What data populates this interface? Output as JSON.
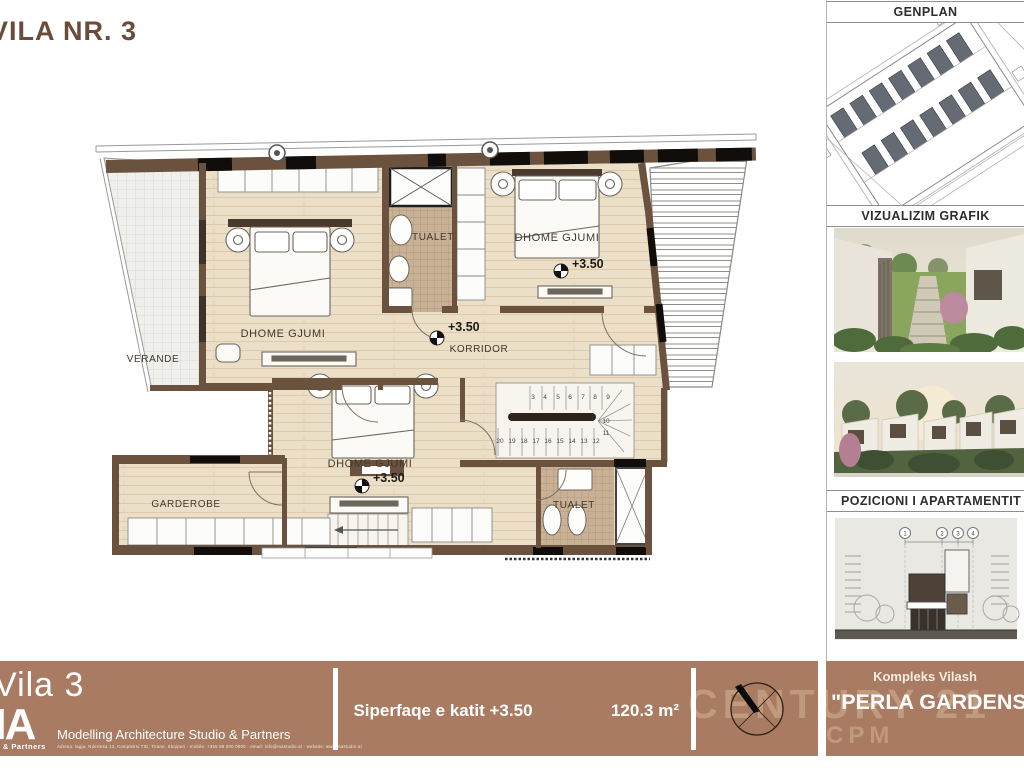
{
  "title": "VILA NR. 3",
  "plan": {
    "labels": {
      "bedroom": "DHOME GJUMI",
      "toilet": "TUALET",
      "corridor": "KORRIDOR",
      "veranda": "VERANDE",
      "wardrobe": "GARDEROBE",
      "level": "+3.50"
    },
    "stairs": {
      "top": [
        "3",
        "4",
        "5",
        "6",
        "7",
        "8",
        "9"
      ],
      "right": [
        "10",
        "11"
      ],
      "bottom": [
        "20",
        "19",
        "18",
        "17",
        "16",
        "15",
        "14",
        "13",
        "12"
      ]
    }
  },
  "sidebar": {
    "genplan_title": "GENPLAN",
    "visual_title": "VIZUALIZIM GRAFIK",
    "position_title": "POZICIONI I APARTAMENTIT NË OBJEKT",
    "elevation_grid": [
      "1",
      "2",
      "3",
      "4"
    ]
  },
  "footer": {
    "villa_name": "Vila 3",
    "logo_text": "MA",
    "logo_sub": "Studio & Partners",
    "company": "Modelling Architecture Studio & Partners",
    "address_line": "Adresa: lagja, Ndertesa 13, Kompleksi TID, Tirane, Shqiperi · mobile: +355 69 000 0000 · email: info@mastudio.al · website: www.mastudio.al",
    "area_label": "Siperfaqe e katit +3.50",
    "area_value": "120.3 m²",
    "complex_label": "Kompleks Vilash",
    "project_name": "\"PERLA GARDENS\"",
    "watermark_line1": "CENTURY 21",
    "watermark_line2": "CPM"
  },
  "colors": {
    "bar_brown": "#a87b62",
    "title_brown": "#6b4c3a",
    "wall_brown": "#6a523f",
    "floor_beige": "#ecdfc7",
    "tile_tan": "#c9b196",
    "watermark_tan": "#c7a283"
  }
}
